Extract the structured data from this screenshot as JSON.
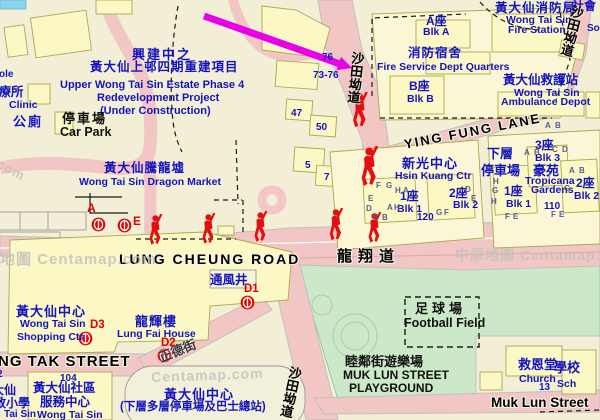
{
  "map": {
    "provider": "Centamap watermark map of Wong Tai Sin",
    "colors": {
      "land": "#F2EFD6",
      "road": "#F2C6C4",
      "green": "#CBE9C8",
      "building_fill": "#FCF8C6",
      "building_stroke": "#A9A94F",
      "blue_text": "#1414BE",
      "red_marker": "#DD0A0A",
      "arrow": "#E800E8",
      "watermark": "#C4C2BC",
      "pool": "#8AD4EE"
    },
    "labels": [
      {
        "t": "興建中之",
        "x": 132,
        "y": 48,
        "c": "cb",
        "fs": 13,
        "ls": 2
      },
      {
        "t": "黃大仙上邨四期重建項目",
        "x": 90,
        "y": 61,
        "c": "cb",
        "fs": 12.5,
        "ls": 1
      },
      {
        "t": "Upper Wong Tai Sin Estate Phase 4",
        "x": 60,
        "y": 80,
        "c": "eb",
        "fs": 11
      },
      {
        "t": "Redevelopment Project",
        "x": 97,
        "y": 93,
        "c": "eb",
        "fs": 11
      },
      {
        "t": "(Under Construction)",
        "x": 100,
        "y": 106,
        "c": "eb",
        "fs": 11
      },
      {
        "t": "ole",
        "x": -1,
        "y": 70,
        "c": "eb",
        "fs": 10
      },
      {
        "t": "診療所",
        "x": -14,
        "y": 86,
        "c": "cb",
        "fs": 12.5
      },
      {
        "t": "Clinic",
        "x": 9,
        "y": 100,
        "c": "eb",
        "fs": 10.5
      },
      {
        "t": "公廁",
        "x": 13,
        "y": 115,
        "c": "cb",
        "fs": 13,
        "ls": 2
      },
      {
        "t": "停車場",
        "x": 62,
        "y": 112,
        "c": "cblk",
        "fs": 13,
        "ls": 2
      },
      {
        "t": "Car Park",
        "x": 60,
        "y": 126,
        "c": "eblk",
        "fs": 12.5
      },
      {
        "t": "黃大仙騰龍墟",
        "x": 104,
        "y": 162,
        "c": "cb",
        "fs": 12.5,
        "ls": 1
      },
      {
        "t": "Wong Tai Sin Dragon Market",
        "x": 79,
        "y": 177,
        "c": "eb",
        "fs": 10.5
      },
      {
        "t": "76",
        "x": 322,
        "y": 53,
        "c": "nb",
        "fs": 10
      },
      {
        "t": "73-76",
        "x": 313,
        "y": 71,
        "c": "nb",
        "fs": 10
      },
      {
        "t": "47",
        "x": 291,
        "y": 109,
        "c": "nb",
        "fs": 10
      },
      {
        "t": "50",
        "x": 316,
        "y": 123,
        "c": "nb",
        "fs": 10
      },
      {
        "t": "5",
        "x": 305,
        "y": 161,
        "c": "nb",
        "fs": 10
      },
      {
        "t": "7",
        "x": 324,
        "y": 173,
        "c": "nb",
        "fs": 10
      },
      {
        "t": "A座",
        "x": 426,
        "y": 15,
        "c": "cb",
        "fs": 12
      },
      {
        "t": "Blk A",
        "x": 423,
        "y": 27,
        "c": "eb",
        "fs": 10.5
      },
      {
        "t": "消防宿舍",
        "x": 408,
        "y": 47,
        "c": "cb",
        "fs": 12.5,
        "ls": 1
      },
      {
        "t": "Fire Service Dept Quarters",
        "x": 377,
        "y": 62,
        "c": "eb",
        "fs": 10.5
      },
      {
        "t": "B座",
        "x": 409,
        "y": 80,
        "c": "cb",
        "fs": 12
      },
      {
        "t": "Blk B",
        "x": 407,
        "y": 94,
        "c": "eb",
        "fs": 10.5
      },
      {
        "t": "黃大仙消防局",
        "x": 495,
        "y": 2,
        "c": "cb",
        "fs": 12.5,
        "ls": 1
      },
      {
        "t": "Wong Tai Sin",
        "x": 506,
        "y": 15,
        "c": "eb",
        "fs": 10.5
      },
      {
        "t": "Fire Station",
        "x": 508,
        "y": 25,
        "c": "eb",
        "fs": 10.5
      },
      {
        "t": "黃大仙救護站",
        "x": 503,
        "y": 74,
        "c": "cb",
        "fs": 12.5
      },
      {
        "t": "Wong Tai Sin",
        "x": 514,
        "y": 88,
        "c": "eb",
        "fs": 10.5
      },
      {
        "t": "Ambulance Depot",
        "x": 501,
        "y": 97,
        "c": "eb",
        "fs": 10.5
      },
      {
        "t": "社會",
        "x": 572,
        "y": 0,
        "c": "cb",
        "fs": 12
      },
      {
        "t": "So",
        "x": 587,
        "y": 24,
        "c": "eb",
        "fs": 10
      },
      {
        "t": "新光中心",
        "x": 402,
        "y": 157,
        "c": "cb",
        "fs": 13,
        "ls": 1
      },
      {
        "t": "Hsin Kuang Ctr",
        "x": 395,
        "y": 171,
        "c": "eb",
        "fs": 10.5
      },
      {
        "t": "1座",
        "x": 400,
        "y": 190,
        "c": "cb",
        "fs": 12
      },
      {
        "t": "Blk 1",
        "x": 397,
        "y": 204,
        "c": "eb",
        "fs": 10.5
      },
      {
        "t": "2座",
        "x": 449,
        "y": 187,
        "c": "cb",
        "fs": 12
      },
      {
        "t": "Blk 2",
        "x": 453,
        "y": 200,
        "c": "eb",
        "fs": 10.5
      },
      {
        "t": "120",
        "x": 417,
        "y": 213,
        "c": "nb",
        "fs": 10
      },
      {
        "t": "下層",
        "x": 487,
        "y": 147,
        "c": "cb",
        "fs": 13
      },
      {
        "t": "停車場",
        "x": 481,
        "y": 164,
        "c": "cb",
        "fs": 13
      },
      {
        "t": "3座",
        "x": 535,
        "y": 139,
        "c": "cb",
        "fs": 12
      },
      {
        "t": "Blk 3",
        "x": 535,
        "y": 153,
        "c": "eb",
        "fs": 10.5
      },
      {
        "t": "豪苑",
        "x": 533,
        "y": 164,
        "c": "cb",
        "fs": 13
      },
      {
        "t": "Tropicana",
        "x": 525,
        "y": 176,
        "c": "eb",
        "fs": 10.5
      },
      {
        "t": "Gardens",
        "x": 531,
        "y": 185,
        "c": "eb",
        "fs": 10.5
      },
      {
        "t": "1座",
        "x": 504,
        "y": 185,
        "c": "cb",
        "fs": 12
      },
      {
        "t": "Blk 1",
        "x": 506,
        "y": 199,
        "c": "eb",
        "fs": 10.5
      },
      {
        "t": "110",
        "x": 544,
        "y": 202,
        "c": "nb",
        "fs": 10
      },
      {
        "t": "2座",
        "x": 576,
        "y": 177,
        "c": "cb",
        "fs": 12
      },
      {
        "t": "Blk 2",
        "x": 574,
        "y": 191,
        "c": "eb",
        "fs": 10.5
      },
      {
        "t": "黃大仙中心",
        "x": 16,
        "y": 305,
        "c": "cb",
        "fs": 13,
        "ls": 1
      },
      {
        "t": "Wong Tai Sin",
        "x": 20,
        "y": 319,
        "c": "eb",
        "fs": 10.5
      },
      {
        "t": "Shopping Ctr",
        "x": 17,
        "y": 332,
        "c": "eb",
        "fs": 10.5
      },
      {
        "t": "龍輝樓",
        "x": 135,
        "y": 315,
        "c": "cb",
        "fs": 13,
        "ls": 1
      },
      {
        "t": "Lung Fai House",
        "x": 117,
        "y": 329,
        "c": "eb",
        "fs": 10.5
      },
      {
        "t": "通風井",
        "x": 210,
        "y": 274,
        "c": "cb",
        "fs": 12.5
      },
      {
        "t": "104",
        "x": 60,
        "y": 374,
        "c": "nb",
        "fs": 10
      },
      {
        "t": "黃大仙社區",
        "x": 33,
        "y": 382,
        "c": "cb",
        "fs": 12.5
      },
      {
        "t": "服務中心",
        "x": 40,
        "y": 396,
        "c": "cb",
        "fs": 12.5
      },
      {
        "t": "Wong Tai Sin",
        "x": 37,
        "y": 410,
        "c": "eb",
        "fs": 10.5
      },
      {
        "t": "大仙",
        "x": -8,
        "y": 384,
        "c": "cb",
        "fs": 12
      },
      {
        "t": "教小學",
        "x": -6,
        "y": 397,
        "c": "cb",
        "fs": 12
      },
      {
        "t": "Tai Sin",
        "x": 4,
        "y": 410,
        "c": "eb",
        "fs": 10
      },
      {
        "t": "2",
        "x": -3,
        "y": 370,
        "c": "nb",
        "fs": 10
      },
      {
        "t": "黃大仙中心",
        "x": 164,
        "y": 388,
        "c": "cb",
        "fs": 13,
        "ls": 1
      },
      {
        "t": "(下層多層停車場及巴士總站)",
        "x": 120,
        "y": 402,
        "c": "cb",
        "fs": 11.5
      },
      {
        "t": "救恩堂",
        "x": 518,
        "y": 358,
        "c": "cb",
        "fs": 13
      },
      {
        "t": "Church",
        "x": 519,
        "y": 374,
        "c": "eb",
        "fs": 10.5
      },
      {
        "t": "學校",
        "x": 554,
        "y": 361,
        "c": "cb",
        "fs": 13
      },
      {
        "t": "Sch",
        "x": 557,
        "y": 379,
        "c": "eb",
        "fs": 10.5
      },
      {
        "t": "13",
        "x": 539,
        "y": 383,
        "c": "nb",
        "fs": 10
      },
      {
        "t": "LUNG CHEUNG ROAD",
        "x": 119,
        "y": 252,
        "c": "rdl",
        "fs": 14,
        "ls": 2
      },
      {
        "t": "龍翔道",
        "x": 337,
        "y": 249,
        "c": "rdl",
        "fs": 15,
        "ls": 6
      },
      {
        "t": "YING FUNG LANE",
        "x": 403,
        "y": 138,
        "c": "rdl",
        "fs": 13,
        "ls": 2,
        "rot": -11
      },
      {
        "t": "NG TAK STREET",
        "x": -2,
        "y": 354,
        "c": "rdl",
        "fs": 15,
        "ls": 1
      },
      {
        "t": "Muk Lun Street",
        "x": 491,
        "y": 396,
        "c": "rdl",
        "fs": 13.5
      },
      {
        "t": "正德街",
        "x": 157,
        "y": 352,
        "c": "rdo",
        "fs": 13,
        "rot": -22
      },
      {
        "t": "足球場",
        "x": 415,
        "y": 302,
        "c": "cblk",
        "fs": 13,
        "ls": 4
      },
      {
        "t": "Football Field",
        "x": 404,
        "y": 317,
        "c": "eblk",
        "fs": 12.5
      },
      {
        "t": "睦鄰街遊樂場",
        "x": 345,
        "y": 355,
        "c": "cblk",
        "fs": 13
      },
      {
        "t": "MUK LUN STREET",
        "x": 343,
        "y": 369,
        "c": "eblk",
        "fs": 12
      },
      {
        "t": "PLAYGROUND",
        "x": 349,
        "y": 382,
        "c": "eblk",
        "fs": 12
      },
      {
        "t": "沙田坳道",
        "x": 289,
        "y": 365,
        "c": "vrd",
        "rot": 12
      },
      {
        "t": "沙田坳道",
        "x": 351,
        "y": 51,
        "c": "vrd",
        "rot": 6
      },
      {
        "t": "沙田坳道",
        "x": 571,
        "y": 4,
        "c": "vrd",
        "rot": 14
      },
      {
        "t": "A",
        "x": 87,
        "y": 202,
        "c": "rx",
        "fs": 12
      },
      {
        "t": "E",
        "x": 133,
        "y": 215,
        "c": "rx",
        "fs": 12
      },
      {
        "t": "D1",
        "x": 244,
        "y": 284,
        "c": "rx",
        "fs": 11.5
      },
      {
        "t": "D2",
        "x": 161,
        "y": 338,
        "c": "rx",
        "fs": 11.5
      },
      {
        "t": "D3",
        "x": 90,
        "y": 320,
        "c": "rx",
        "fs": 11.5
      },
      {
        "t": "地圖 Centamap.com",
        "x": 0,
        "y": 252,
        "c": "wm",
        "fs": 15
      },
      {
        "t": "中原地圖 Centamap.co",
        "x": 455,
        "y": 248,
        "c": "wm",
        "fs": 14
      },
      {
        "t": "Centamap.com",
        "x": 151,
        "y": 370,
        "c": "wm",
        "fs": 14,
        "rot": -2
      },
      {
        "t": ".com",
        "x": -3,
        "y": 155,
        "c": "wm",
        "fs": 13,
        "rot": 28
      },
      {
        "t": "F",
        "x": 376,
        "y": 182,
        "c": "wl",
        "fs": 8
      },
      {
        "t": "G",
        "x": 386,
        "y": 182,
        "c": "wl",
        "fs": 8
      },
      {
        "t": "H",
        "x": 395,
        "y": 187,
        "c": "wl",
        "fs": 8
      },
      {
        "t": "A",
        "x": 403,
        "y": 187,
        "c": "wl",
        "fs": 8
      },
      {
        "t": "E",
        "x": 368,
        "y": 195,
        "c": "wl",
        "fs": 8
      },
      {
        "t": "D",
        "x": 366,
        "y": 205,
        "c": "wl",
        "fs": 8
      },
      {
        "t": "A",
        "x": 387,
        "y": 204,
        "c": "wl",
        "fs": 8
      },
      {
        "t": "H",
        "x": 394,
        "y": 204,
        "c": "wl",
        "fs": 8
      },
      {
        "t": "C",
        "x": 373,
        "y": 214,
        "c": "wl",
        "fs": 8
      },
      {
        "t": "B",
        "x": 382,
        "y": 214,
        "c": "wl",
        "fs": 8
      },
      {
        "t": "G",
        "x": 436,
        "y": 209,
        "c": "wl",
        "fs": 8
      },
      {
        "t": "F",
        "x": 444,
        "y": 209,
        "c": "wl",
        "fs": 8
      },
      {
        "t": "D",
        "x": 465,
        "y": 186,
        "c": "wl",
        "fs": 8
      },
      {
        "t": "E",
        "x": 471,
        "y": 195,
        "c": "wl",
        "fs": 8
      },
      {
        "t": "A",
        "x": 524,
        "y": 149,
        "c": "wl",
        "fs": 8
      },
      {
        "t": "B",
        "x": 534,
        "y": 149,
        "c": "wl",
        "fs": 8
      },
      {
        "t": "C",
        "x": 552,
        "y": 146,
        "c": "wl",
        "fs": 8
      },
      {
        "t": "D",
        "x": 562,
        "y": 146,
        "c": "wl",
        "fs": 8
      },
      {
        "t": "H",
        "x": 493,
        "y": 178,
        "c": "wl",
        "fs": 8
      },
      {
        "t": "G",
        "x": 492,
        "y": 187,
        "c": "wl",
        "fs": 8
      },
      {
        "t": "H",
        "x": 491,
        "y": 198,
        "c": "wl",
        "fs": 8
      },
      {
        "t": "F",
        "x": 505,
        "y": 213,
        "c": "wl",
        "fs": 8
      },
      {
        "t": "E",
        "x": 513,
        "y": 213,
        "c": "wl",
        "fs": 8
      },
      {
        "t": "A",
        "x": 569,
        "y": 167,
        "c": "wl",
        "fs": 8
      },
      {
        "t": "B",
        "x": 579,
        "y": 167,
        "c": "wl",
        "fs": 8
      },
      {
        "t": "G",
        "x": 564,
        "y": 185,
        "c": "wl",
        "fs": 8
      },
      {
        "t": "F",
        "x": 551,
        "y": 211,
        "c": "wl",
        "fs": 8
      },
      {
        "t": "E",
        "x": 559,
        "y": 211,
        "c": "wl",
        "fs": 8
      },
      {
        "t": "A",
        "x": 545,
        "y": 122,
        "c": "wl",
        "fs": 8
      },
      {
        "t": "B",
        "x": 555,
        "y": 122,
        "c": "wl",
        "fs": 8
      }
    ],
    "mtr_exits": [
      {
        "label": "A",
        "x": 91,
        "y": 217
      },
      {
        "label": "E",
        "x": 117,
        "y": 218
      },
      {
        "label": "D1",
        "x": 240,
        "y": 295
      },
      {
        "label": "D2",
        "x": 157,
        "y": 348
      },
      {
        "label": "D3",
        "x": 78,
        "y": 331
      }
    ],
    "figures": [
      {
        "x": 146,
        "y": 214,
        "s": 1
      },
      {
        "x": 199,
        "y": 213,
        "s": 1
      },
      {
        "x": 251,
        "y": 211,
        "s": 1
      },
      {
        "x": 326,
        "y": 208,
        "s": 1.05
      },
      {
        "x": 365,
        "y": 212,
        "s": 1
      },
      {
        "x": 349,
        "y": 92,
        "s": 1.15
      },
      {
        "x": 357,
        "y": 146,
        "s": 1.3
      }
    ],
    "arrow": {
      "x1": 204,
      "y1": 16,
      "x2": 340,
      "y2": 64,
      "tip_x": 352,
      "tip_y": 68,
      "color": "#E800E8"
    }
  }
}
